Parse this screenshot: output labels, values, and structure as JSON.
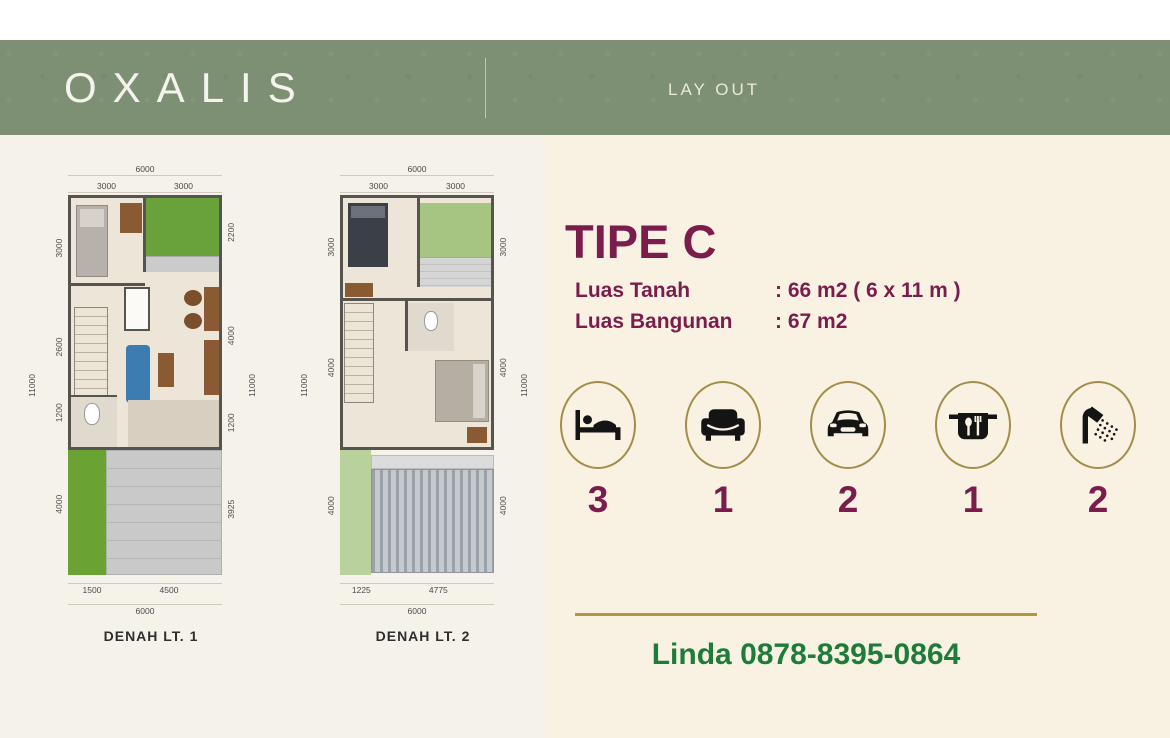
{
  "header": {
    "brand": "OXALIS",
    "page_label": "LAY OUT"
  },
  "plans": [
    {
      "name": "DENAH LT. 1",
      "dims": {
        "top_total": "6000",
        "top": [
          "3000",
          "3000"
        ],
        "left": [
          "3000",
          "2600",
          "1200",
          "4000"
        ],
        "left_total": "11000",
        "right": [
          "2200",
          "4000",
          "1200",
          "3925"
        ],
        "right_total": "11000",
        "bottom": [
          "1500",
          "4500"
        ],
        "bottom_total": "6000"
      }
    },
    {
      "name": "DENAH LT. 2",
      "dims": {
        "top_total": "6000",
        "top": [
          "3000",
          "3000"
        ],
        "left": [
          "3000",
          "4000",
          "4000"
        ],
        "left_total": "11000",
        "right": [
          "3000",
          "4000",
          "4000"
        ],
        "right_total": "11000",
        "bottom": [
          "1225",
          "4775"
        ],
        "bottom_total": "6000"
      }
    }
  ],
  "details": {
    "type_title": "TIPE C",
    "specs": [
      {
        "label": "Luas Tanah",
        "value": ": 66 m2 ( 6 x 11 m )"
      },
      {
        "label": "Luas Bangunan",
        "value": ": 67 m2"
      }
    ],
    "features": [
      {
        "icon": "bed-icon",
        "count": "3"
      },
      {
        "icon": "sofa-icon",
        "count": "1"
      },
      {
        "icon": "car-icon",
        "count": "2"
      },
      {
        "icon": "kitchen-icon",
        "count": "1"
      },
      {
        "icon": "shower-icon",
        "count": "2"
      }
    ],
    "contact": "Linda 0878-8395-0864"
  },
  "colors": {
    "header_green": "#7d9073",
    "maroon": "#7a1d4d",
    "gold": "#b3973c",
    "circle_gold": "#a28e49",
    "contact_green": "#1d7c39",
    "cream": "#f9f2e3"
  }
}
